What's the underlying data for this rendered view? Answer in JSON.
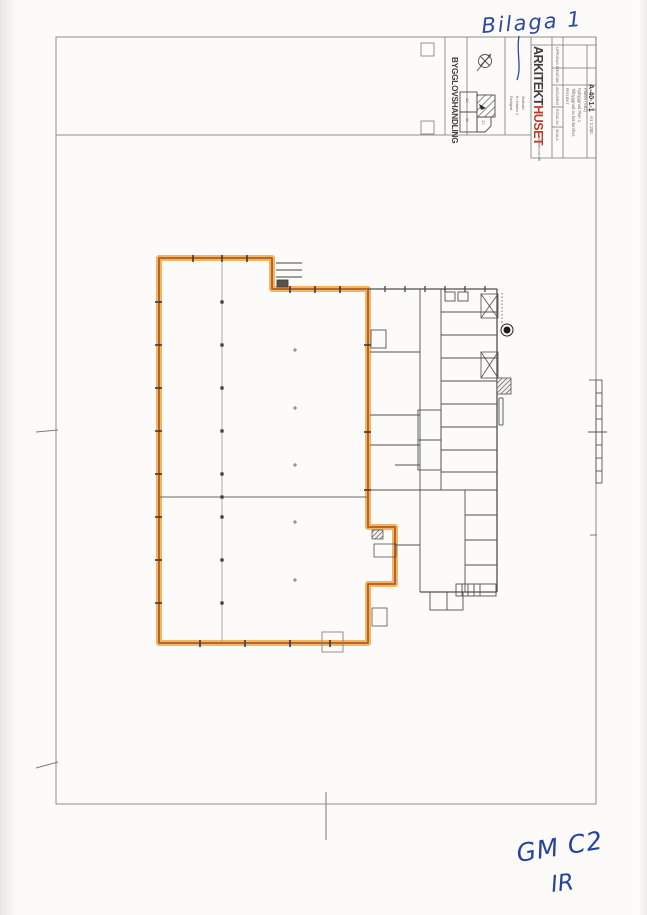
{
  "page": {
    "bilaga_note": "Bilaga 1",
    "signature_line1": "GM C2",
    "signature_line2": "IR",
    "ink_color": "#2b4a9f"
  },
  "title_block": {
    "stamp": "BYGGLOVSHANDLING",
    "logo": {
      "part1": "ARKITEKT",
      "part2": "HUSET",
      "accent_color": "#c03a2e"
    },
    "drawing_number": "A-40-1-1",
    "scale": "A1 1:200",
    "site_plan": {
      "labels": [
        "11",
        "12",
        "13"
      ]
    },
    "fields": [
      "UPPDRAG NR",
      "DATUM",
      "ANSVARIG",
      "RITAD AV",
      "SKALA",
      "PROJEKT"
    ],
    "project_lines": [
      "Tillbyggnad av kontorshus",
      "Nybyggnad  Plan 1",
      "Planer (VB1)"
    ],
    "side_notes": [
      "Fastighet",
      "Kv Hästen 2",
      "Stadsdel"
    ],
    "firm_note": "Arkitekthuset AB"
  },
  "plan": {
    "highlight_color": "#f0a43c",
    "highlight_core": "#aa521d",
    "wall_color": "#50504c"
  }
}
